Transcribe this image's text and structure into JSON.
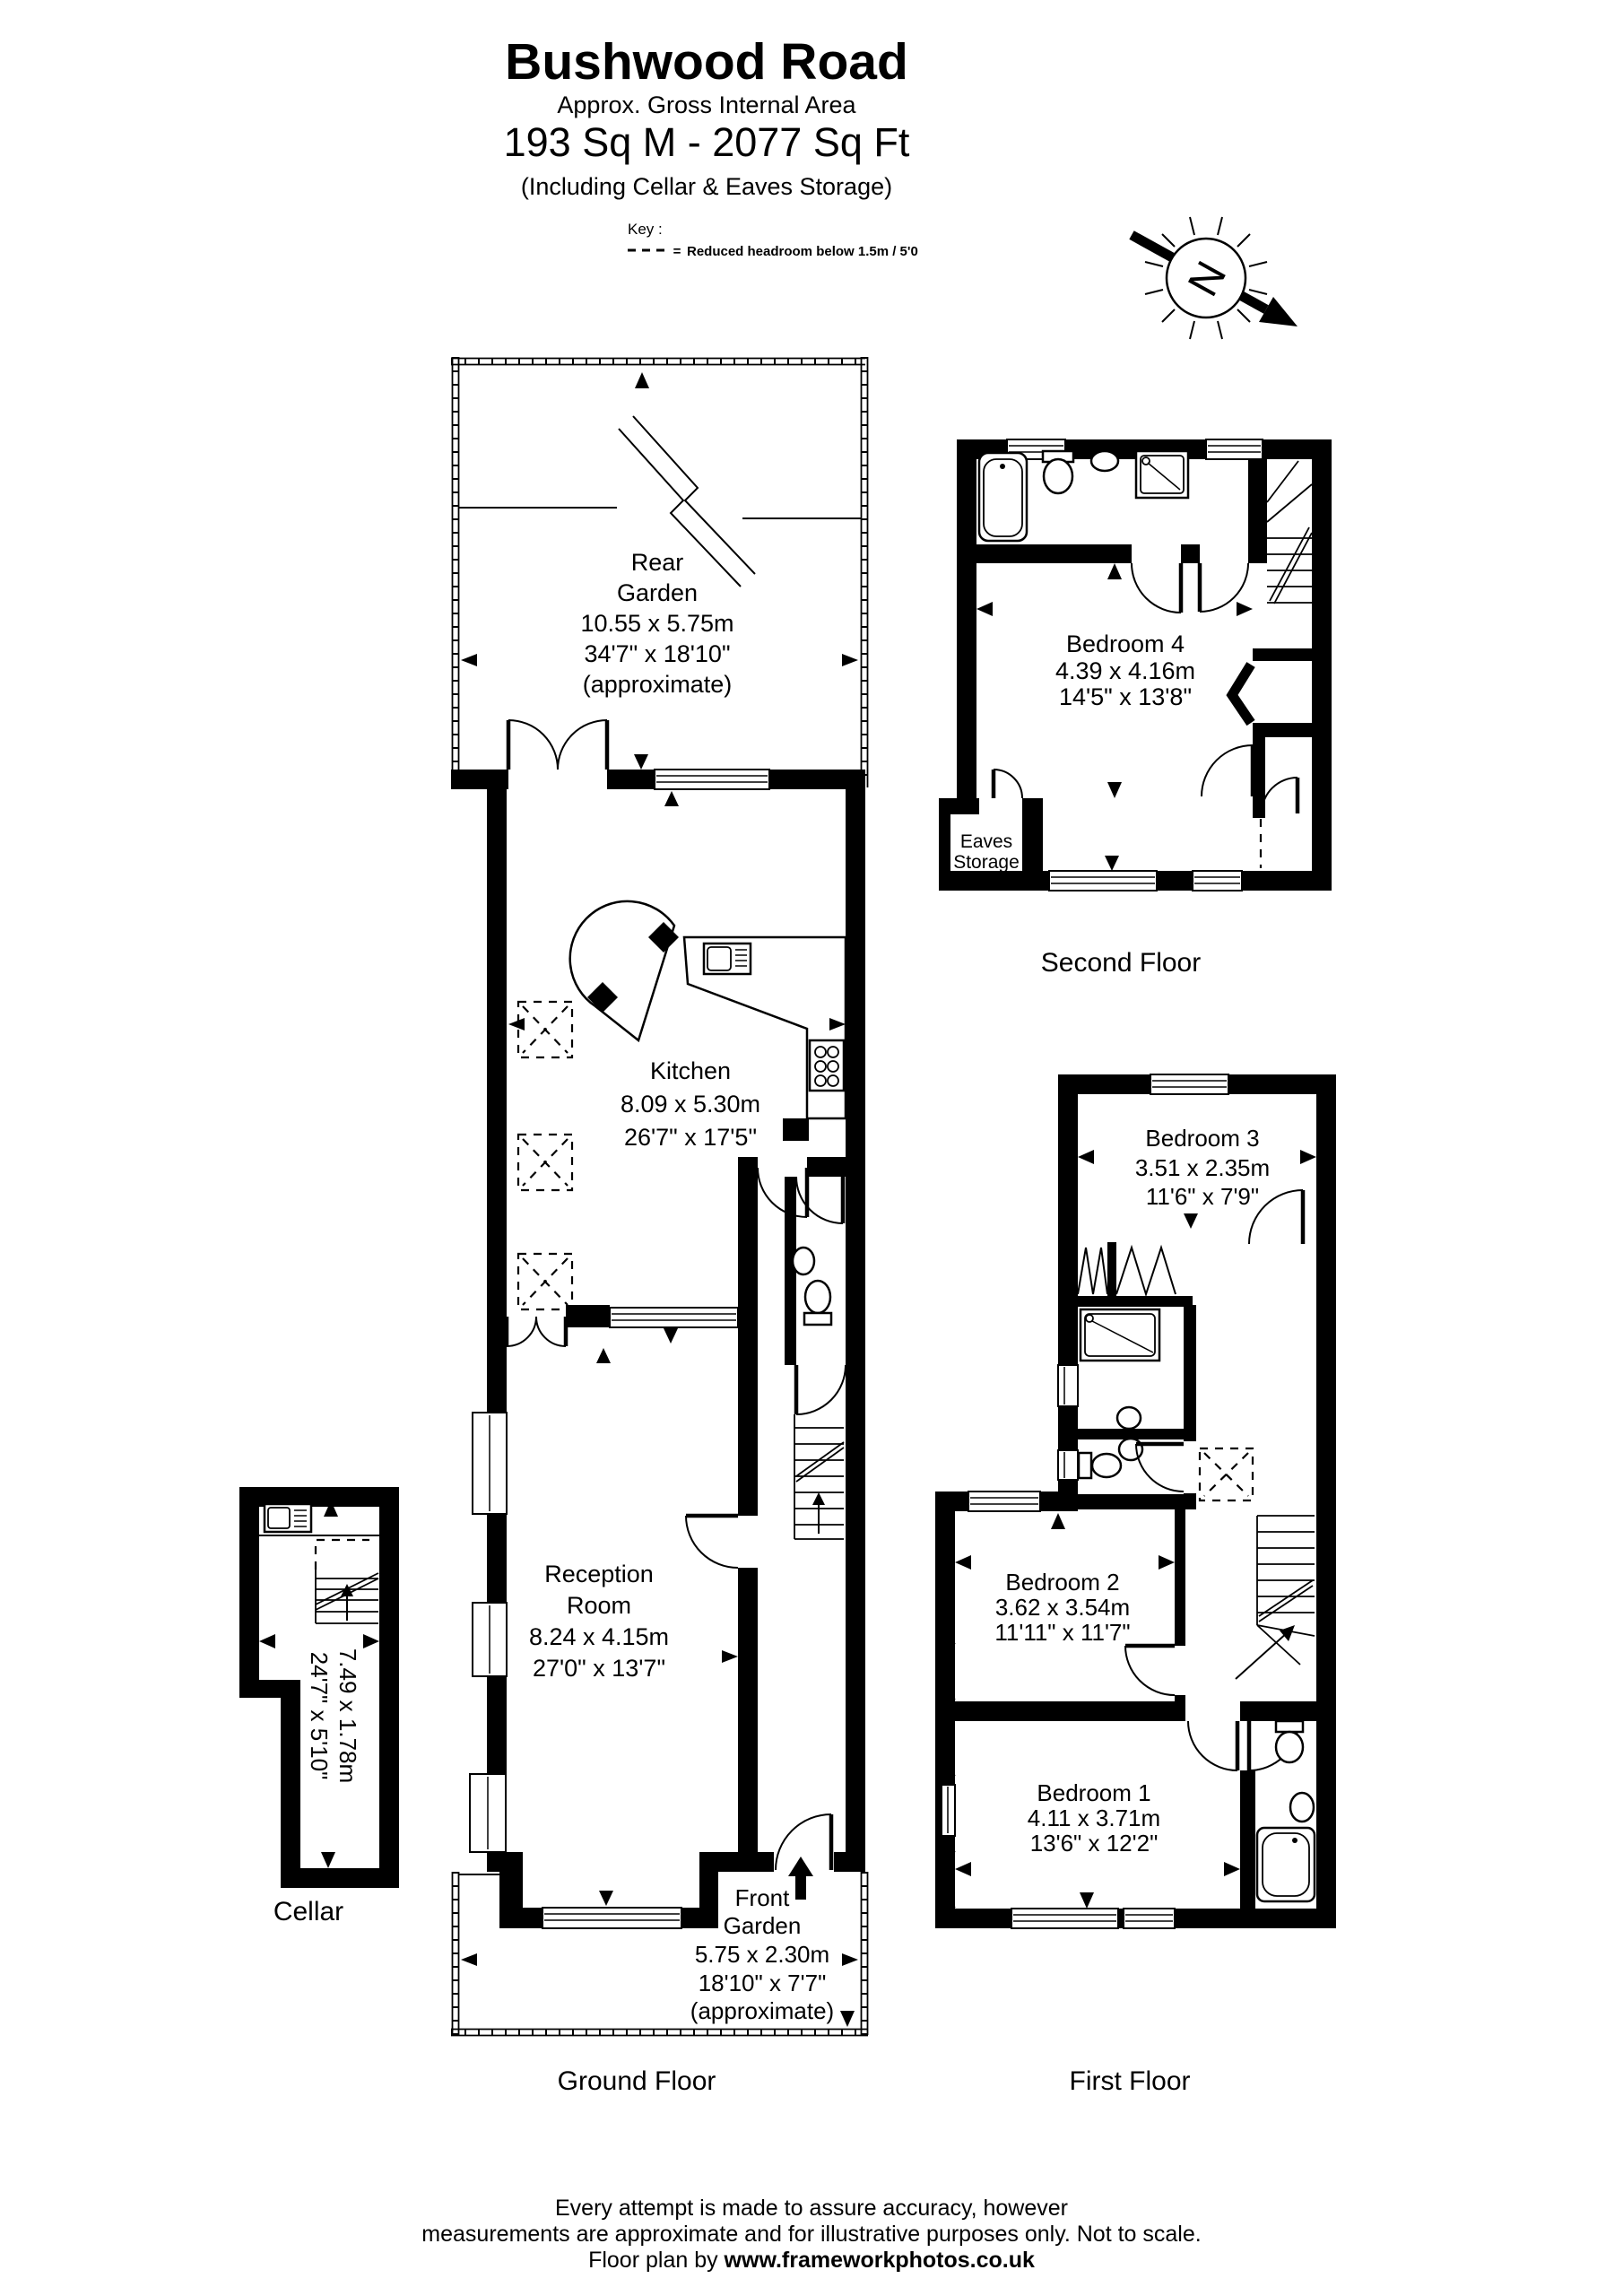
{
  "colors": {
    "ink": "#000000",
    "paper": "#ffffff"
  },
  "header": {
    "title": "Bushwood Road",
    "subtitle": "Approx. Gross Internal Area",
    "area": "193 Sq M - 2077 Sq Ft",
    "including": "(Including Cellar & Eaves Storage)"
  },
  "key": {
    "label": "Key :",
    "equals": "=",
    "description": "Reduced  headroom below 1.5m / 5'0"
  },
  "compass": {
    "letter": "N"
  },
  "rooms": {
    "rear_garden": {
      "name1": "Rear",
      "name2": "Garden",
      "metric": "10.55 x 5.75m",
      "imperial": "34'7\" x 18'10\"",
      "note": "(approximate)"
    },
    "kitchen": {
      "name": "Kitchen",
      "metric": "8.09 x 5.30m",
      "imperial": "26'7\" x 17'5\""
    },
    "reception": {
      "name1": "Reception",
      "name2": "Room",
      "metric": "8.24 x 4.15m",
      "imperial": "27'0\" x 13'7\""
    },
    "front_garden": {
      "name1": "Front",
      "name2": "Garden",
      "metric": "5.75 x 2.30m",
      "imperial": "18'10\" x 7'7\"",
      "note": "(approximate)"
    },
    "bedroom4": {
      "name": "Bedroom 4",
      "metric": "4.39 x 4.16m",
      "imperial": "14'5\" x 13'8\""
    },
    "eaves": {
      "name1": "Eaves",
      "name2": "Storage"
    },
    "bedroom3": {
      "name": "Bedroom 3",
      "metric": "3.51 x 2.35m",
      "imperial": "11'6\" x 7'9\""
    },
    "bedroom2": {
      "name": "Bedroom 2",
      "metric": "3.62 x 3.54m",
      "imperial": "11'11\" x 11'7\""
    },
    "bedroom1": {
      "name": "Bedroom 1",
      "metric": "4.11 x 3.71m",
      "imperial": "13'6\" x 12'2\""
    },
    "cellar": {
      "metric": "7.49 x 1.78m",
      "imperial": "24'7\" x 5'10\""
    }
  },
  "floors": {
    "ground": "Ground Floor",
    "first": "First Floor",
    "second": "Second Floor",
    "cellar": "Cellar"
  },
  "footer": {
    "line1": "Every attempt is made to assure accuracy, however",
    "line2": "measurements are approximate and for illustrative purposes only. Not to scale.",
    "line3_prefix": "Floor plan by  ",
    "line3_url": "www.frameworkphotos.co.uk"
  }
}
